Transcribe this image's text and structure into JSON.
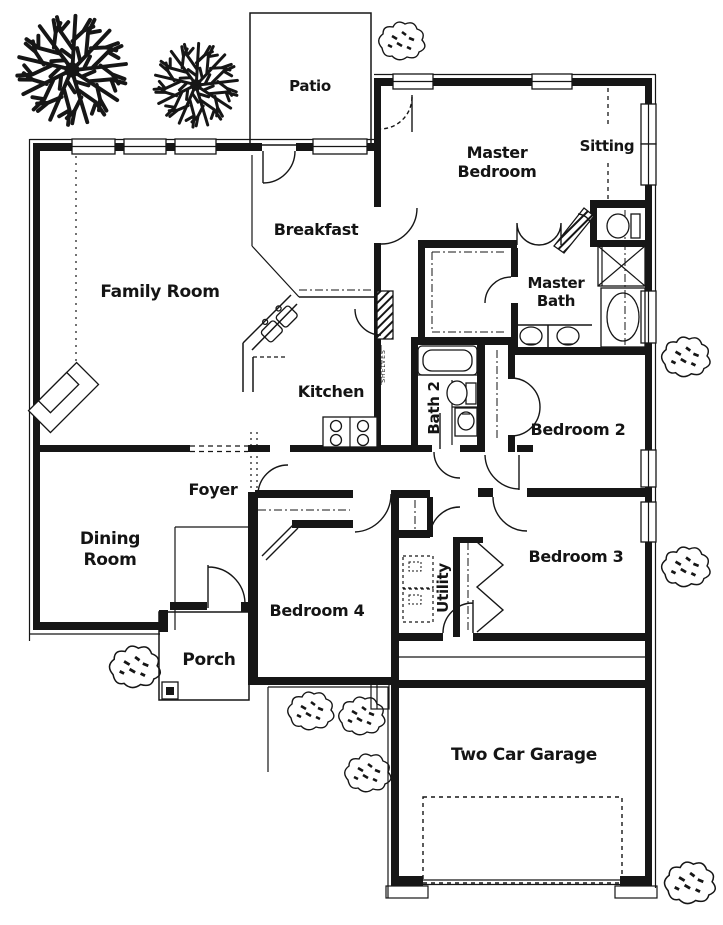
{
  "labels": {
    "patio": "Patio",
    "master_bedroom_line1": "Master",
    "master_bedroom_line2": "Bedroom",
    "sitting": "Sitting",
    "breakfast": "Breakfast",
    "family_room": "Family Room",
    "master_bath_line1": "Master",
    "master_bath_line2": "Bath",
    "kitchen": "Kitchen",
    "bath2": "Bath 2",
    "bedroom2": "Bedroom 2",
    "foyer": "Foyer",
    "dining_line1": "Dining",
    "dining_line2": "Room",
    "bedroom3": "Bedroom 3",
    "utility": "Utility",
    "bedroom4": "Bedroom 4",
    "porch": "Porch",
    "garage": "Two Car Garage",
    "pantry_shelves": "SHELVES"
  },
  "icons": {
    "tree": "deciduous-tree-top-view",
    "shrub": "shrub-top-view",
    "door": "quarter-circle-swing-arc",
    "window": "double-line-window",
    "shower": "x-cross-square",
    "toilet": "oval-bowl-with-tank",
    "bathtub": "oval-in-rectangle",
    "sink": "oval-basin",
    "stove": "four-burner-cooktop",
    "fireplace": "angled-corner-firebox",
    "washer_dryer": "dashed-appliance-squares",
    "garage_parking": "dashed-rectangle",
    "closet_shelf": "dash-dot-line"
  },
  "colors": {
    "ink": "#161616",
    "paper": "#ffffff"
  }
}
